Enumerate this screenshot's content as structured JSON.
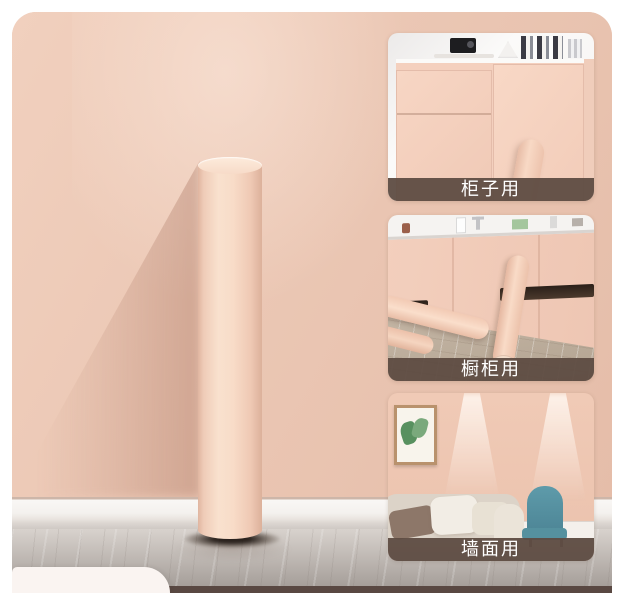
{
  "main_image": {
    "subject": "pink self-adhesive wallpaper roll standing against pink wall",
    "colors": {
      "wall_pink": "#ebc7b4",
      "roll_pink": "#f8dcc8",
      "baseboard_white": "#f4f1ee",
      "floor_marble_gray": "#b3aca6",
      "bottom_strip_brown": "#594842",
      "next_card_white": "#faf4f1"
    }
  },
  "thumbnails": [
    {
      "id": "cabinet-use",
      "label": "柜子用"
    },
    {
      "id": "kitchen-cabinet-use",
      "label": "橱柜用"
    },
    {
      "id": "wall-use",
      "label": "墙面用"
    }
  ],
  "label_style": {
    "bar_color": "#5e4c42",
    "text_color": "#ffffff"
  },
  "scene_colors": {
    "chair_teal": "#5795a5",
    "plant_green": "#58905f",
    "wood_floor": "#c4b3a0"
  }
}
